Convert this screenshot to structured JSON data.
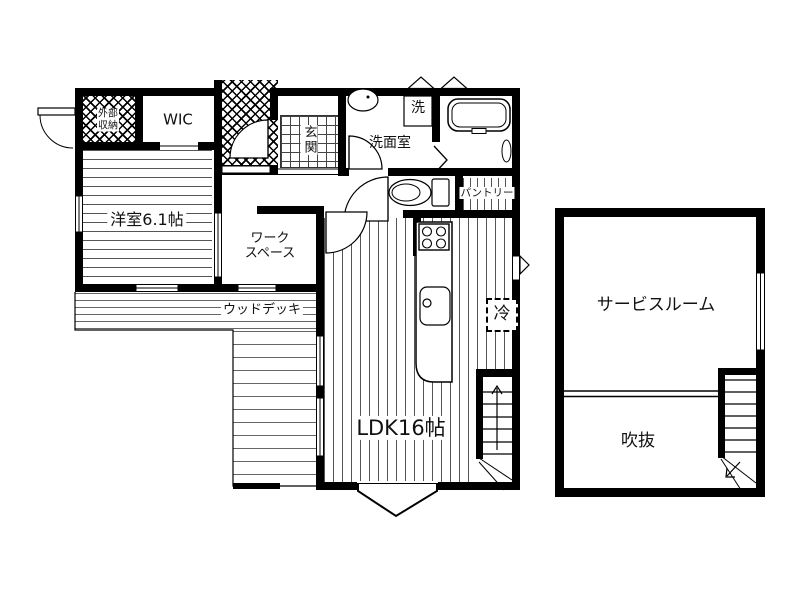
{
  "colors": {
    "wall": "#000000",
    "floor_line": "#555555",
    "background": "#ffffff"
  },
  "first_floor": {
    "exterior_storage_line1": "外部",
    "exterior_storage_line2": "収納",
    "wic": "WIC",
    "entrance": "玄関",
    "washroom": "洗面室",
    "washer": "洗",
    "pantry": "パントリー",
    "western_room": "洋室6.1帖",
    "workspace_line1": "ワーク",
    "workspace_line2": "スペース",
    "wood_deck": "ウッドデッキ",
    "ldk": "LDK16帖",
    "fridge": "冷"
  },
  "second_floor": {
    "service_room": "サービスルーム",
    "void": "吹抜"
  }
}
